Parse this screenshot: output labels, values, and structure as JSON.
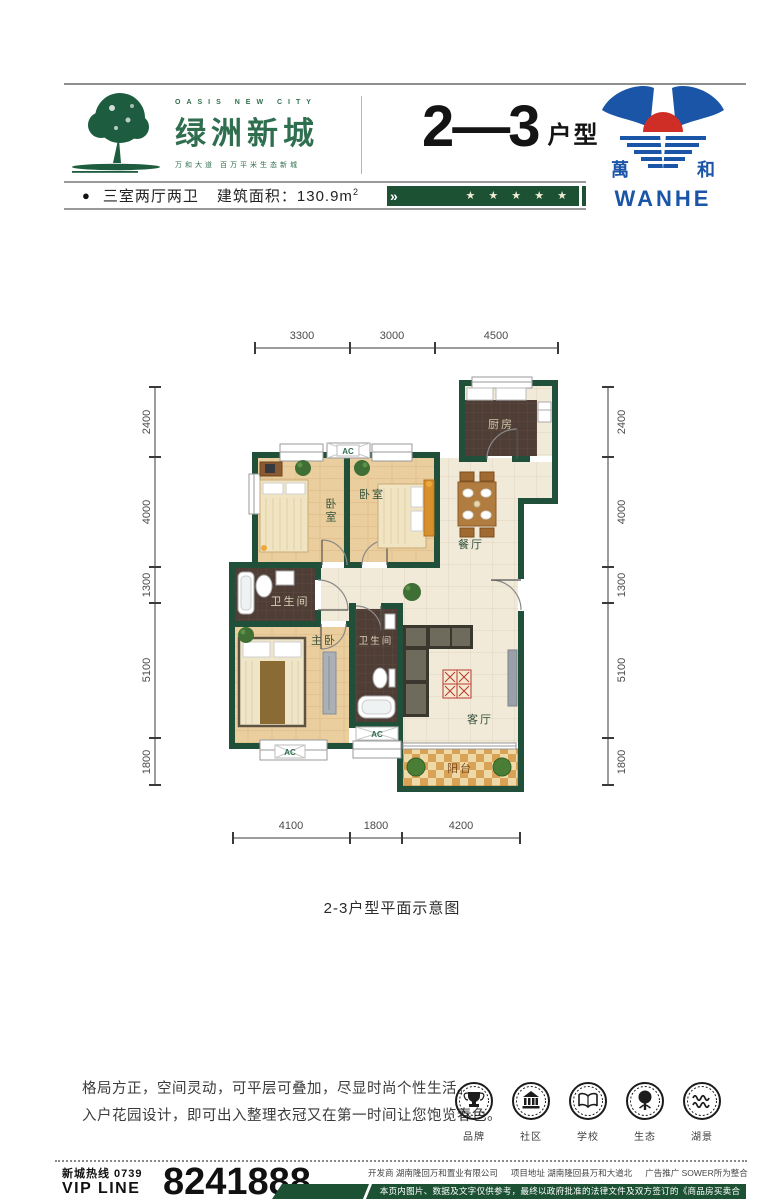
{
  "header": {
    "brand_en": "OASIS NEW CITY",
    "brand_cn": "绿洲新城",
    "tagline": "万和大道  百万平米生态新城",
    "unit_number": "2—3",
    "unit_suffix": "户型",
    "logo_cn_left": "萬",
    "logo_cn_right": "和",
    "logo_en": "WANHE"
  },
  "info_bar": {
    "bullet": "●",
    "layout": "三室两厅两卫",
    "area_label": "建筑面积：",
    "area_value": "130.9m",
    "area_sup": "2",
    "chevron": "»",
    "stars": "★ ★ ★ ★ ★"
  },
  "floor_plan": {
    "caption": "2-3户型平面示意图",
    "rooms": {
      "kitchen": "厨房",
      "bedroom1": "卧室",
      "bedroom2": "卧室",
      "dining": "餐厅",
      "bath1": "卫生间",
      "bath2": "卫生间",
      "master": "主卧",
      "living": "客厅",
      "balcony": "阳台",
      "ac": "AC"
    },
    "dims_top": [
      "3300",
      "3000",
      "4500"
    ],
    "dims_left": [
      "2400",
      "4000",
      "1300",
      "5100",
      "1800"
    ],
    "dims_right": [
      "2400",
      "4000",
      "1300",
      "5100",
      "1800"
    ],
    "dims_bottom": [
      "4100",
      "1800",
      "4200"
    ]
  },
  "description": {
    "line1": "格局方正，空间灵动，可平层可叠加，尽显时尚个性生活。",
    "line2": "入户花园设计，即可出入整理衣冠又在第一时间让您饱览春色。"
  },
  "features": [
    {
      "icon": "trophy-icon",
      "label": "品牌"
    },
    {
      "icon": "community-icon",
      "label": "社区"
    },
    {
      "icon": "school-icon",
      "label": "学校"
    },
    {
      "icon": "ecology-icon",
      "label": "生态"
    },
    {
      "icon": "lakeview-icon",
      "label": "湖景"
    }
  ],
  "footer": {
    "hotline_label": "新城热线 0739",
    "vip_label": "VIP LINE",
    "phone": "8241888",
    "developer": "开发商 湖南隆回万和置业有限公司",
    "address": "项目地址 湖南隆回县万和大道北",
    "agency": "广告推广 SOWER所为整合",
    "disclaimer": "本页内图片、数据及文字仅供参考，最终以政府批准的法律文件及双方签订的《商品房买卖合同》为准。"
  },
  "colors": {
    "brand_green": "#2f6e4e",
    "wall_green": "#20503a",
    "bar_green": "#1c5134",
    "logo_blue": "#1b55a8",
    "logo_red": "#cf2e26"
  }
}
